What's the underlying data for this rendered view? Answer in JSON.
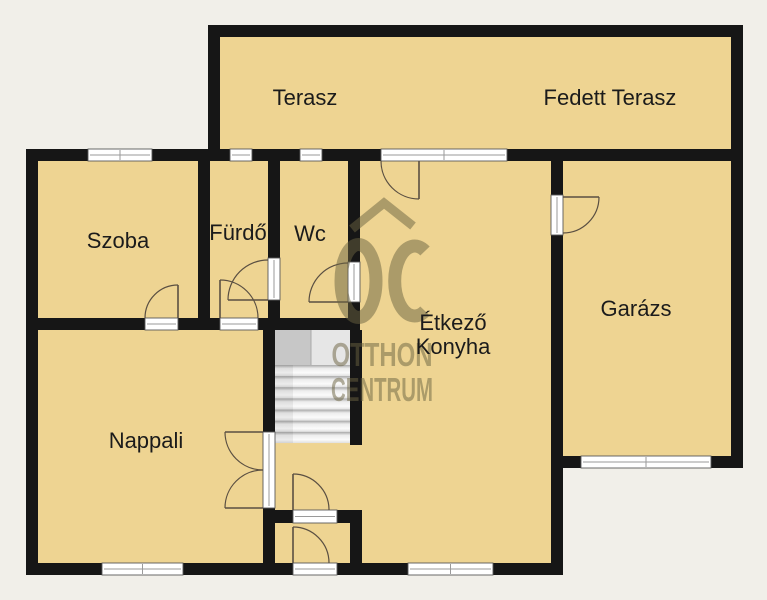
{
  "plan_title": "floor-plan",
  "colors": {
    "background": "#f1efe9",
    "floor": "#eed492",
    "wall": "#161616",
    "opening_fill": "#ffffff",
    "opening_stroke": "#5a5a5a",
    "opening_line": "#9a9a9a",
    "door_arc": "#5a4f42",
    "stairs_base": "#d2d2d2",
    "watermark": "#6b6341",
    "label": "#1b1b1b"
  },
  "rooms": [
    {
      "id": "terasz",
      "label": "Terasz"
    },
    {
      "id": "fedett-terasz",
      "label": "Fedett Terasz"
    },
    {
      "id": "szoba",
      "label": "Szoba"
    },
    {
      "id": "furdo",
      "label": "Fürdő"
    },
    {
      "id": "wc",
      "label": "Wc"
    },
    {
      "id": "etkezo-konyha",
      "label_line1": "Étkező",
      "label_line2": "Konyha"
    },
    {
      "id": "garazs",
      "label": "Garázs"
    },
    {
      "id": "nappali",
      "label": "Nappali"
    }
  ],
  "watermark": {
    "monogram": "OC",
    "line1": "OTTHON",
    "line2": "CENTRUM"
  },
  "floorplan": {
    "floors": [
      {
        "name": "terrace-floor",
        "r": [
          208,
          25,
          535,
          137
        ]
      },
      {
        "name": "house-floor",
        "r": [
          26,
          149,
          537,
          426
        ]
      },
      {
        "name": "garage-floor",
        "r": [
          551,
          149,
          192,
          319
        ]
      }
    ],
    "walls": [
      {
        "name": "terrace-top-wall",
        "r": [
          208,
          25,
          535,
          12
        ]
      },
      {
        "name": "terrace-left-wall",
        "r": [
          208,
          25,
          12,
          136
        ]
      },
      {
        "name": "outer-right-wall",
        "r": [
          731,
          25,
          12,
          443
        ]
      },
      {
        "name": "main-top-wall",
        "r": [
          26,
          149,
          717,
          12
        ]
      },
      {
        "name": "house-left-wall",
        "r": [
          26,
          149,
          12,
          426
        ]
      },
      {
        "name": "house-bottom-wall",
        "r": [
          26,
          563,
          537,
          12
        ]
      },
      {
        "name": "lower-right-wall",
        "r": [
          551,
          456,
          12,
          119
        ]
      },
      {
        "name": "garage-bottom-wall",
        "r": [
          551,
          456,
          192,
          12
        ]
      },
      {
        "name": "garage-left-wall",
        "r": [
          551,
          161,
          12,
          295
        ]
      },
      {
        "name": "szoba-right-wall",
        "r": [
          198,
          161,
          12,
          169
        ]
      },
      {
        "name": "furdo-right-wall",
        "r": [
          268,
          161,
          12,
          169
        ]
      },
      {
        "name": "wc-right-wall",
        "r": [
          348,
          161,
          12,
          169
        ]
      },
      {
        "name": "bedroom-row-bottom-wall",
        "r": [
          26,
          318,
          334,
          12
        ]
      },
      {
        "name": "nappali-right-wall",
        "r": [
          263,
          330,
          12,
          233
        ]
      },
      {
        "name": "stairs-right-wall",
        "r": [
          350,
          330,
          12,
          115
        ]
      },
      {
        "name": "vestibule-top-wall",
        "r": [
          263,
          510,
          99,
          13
        ]
      },
      {
        "name": "vestibule-right-wall",
        "r": [
          350,
          510,
          12,
          65
        ]
      }
    ],
    "windows": [
      {
        "name": "szoba-window",
        "r": [
          88,
          149,
          64,
          12
        ],
        "o": "h",
        "tick": true
      },
      {
        "name": "furdo-window",
        "r": [
          230,
          149,
          22,
          12
        ],
        "o": "h"
      },
      {
        "name": "wc-window",
        "r": [
          300,
          149,
          22,
          12
        ],
        "o": "h"
      },
      {
        "name": "terrace-door-window",
        "r": [
          381,
          149,
          126,
          12
        ],
        "o": "h",
        "tick": true
      },
      {
        "name": "nappali-window",
        "r": [
          102,
          563,
          81,
          12
        ],
        "o": "h",
        "tick": true
      },
      {
        "name": "etkezo-window",
        "r": [
          408,
          563,
          85,
          12
        ],
        "o": "h",
        "tick": true
      },
      {
        "name": "garage-window",
        "r": [
          581,
          456,
          130,
          12
        ],
        "o": "h",
        "tick": true
      }
    ],
    "door_openings": [
      {
        "name": "garage-door-opening",
        "r": [
          551,
          195,
          12,
          40
        ],
        "o": "v"
      },
      {
        "name": "furdo-wc-door-opening",
        "r": [
          268,
          258,
          12,
          42
        ],
        "o": "v"
      },
      {
        "name": "wc-door-opening",
        "r": [
          348,
          262,
          12,
          40
        ],
        "o": "v"
      },
      {
        "name": "szoba-door-opening",
        "r": [
          145,
          318,
          33,
          12
        ],
        "o": "h"
      },
      {
        "name": "furdo-door-opening",
        "r": [
          220,
          318,
          38,
          12
        ],
        "o": "h"
      },
      {
        "name": "nappali-double-door-opening",
        "r": [
          263,
          432,
          12,
          76
        ],
        "o": "v"
      },
      {
        "name": "vestibule-door-opening",
        "r": [
          293,
          510,
          44,
          13
        ],
        "o": "h"
      },
      {
        "name": "entry-door-opening",
        "r": [
          293,
          563,
          44,
          12
        ],
        "o": "h"
      }
    ],
    "door_arcs": [
      {
        "name": "terrace-door",
        "arc": "M 381 161 A 38 38 0 0 0 419 199",
        "leaf": "M 419 161 L 419 199"
      },
      {
        "name": "garage-door",
        "arc": "M 599 197 A 36 36 0 0 1 563 233",
        "leaf": "M 563 197 L 599 197"
      },
      {
        "name": "furdo-wc-door",
        "arc": "M 268 260 A 40 40 0 0 0 228 300",
        "leaf": "M 268 300 L 228 300"
      },
      {
        "name": "wc-door",
        "arc": "M 348 263 A 39 39 0 0 0 309 302",
        "leaf": "M 348 302 L 309 302"
      },
      {
        "name": "szoba-door",
        "arc": "M 145 318 A 33 33 0 0 1 178 285",
        "leaf": "M 178 318 L 178 285"
      },
      {
        "name": "furdo-door",
        "arc": "M 258 318 A 38 38 0 0 0 220 280",
        "leaf": "M 220 318 L 220 280"
      },
      {
        "name": "nappali-door-top",
        "arc": "M 263 470 A 38 38 0 0 1 225 432",
        "leaf": "M 263 432 L 225 432"
      },
      {
        "name": "nappali-door-bottom",
        "arc": "M 263 470 A 38 38 0 0 0 225 508",
        "leaf": "M 263 508 L 225 508"
      },
      {
        "name": "vestibule-door",
        "arc": "M 329 510 A 36 36 0 0 0 293 474",
        "leaf": "M 293 510 L 293 474"
      },
      {
        "name": "entry-door",
        "arc": "M 329 563 A 36 36 0 0 0 293 527",
        "leaf": "M 293 563 L 293 527"
      }
    ],
    "stairs": {
      "x": 275,
      "y": 330,
      "w": 75,
      "h": 113,
      "landing_h": 35,
      "divider_x": 311,
      "steps": 7,
      "step_h": 11.15,
      "steps_top": 365
    }
  }
}
